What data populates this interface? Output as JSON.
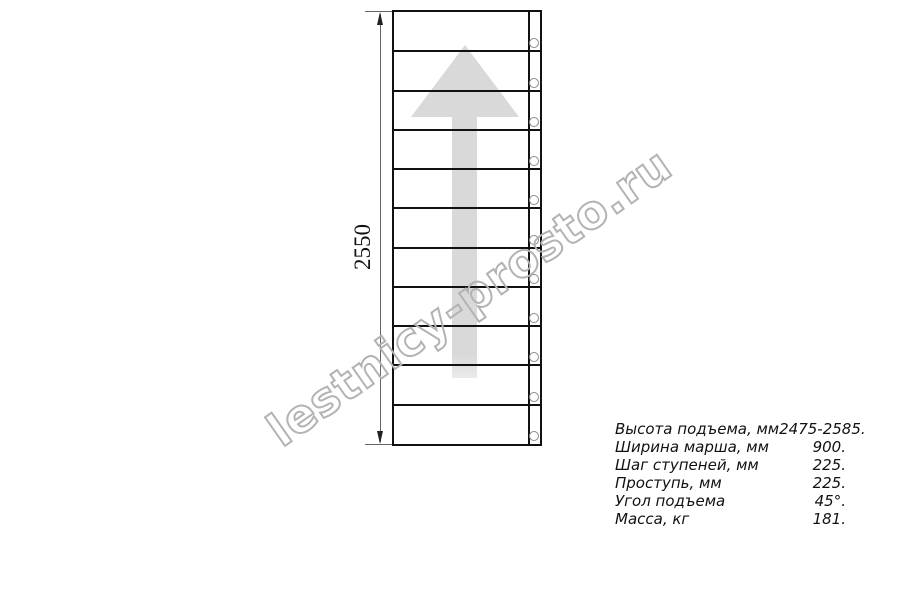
{
  "diagram": {
    "type": "staircase-plan-top-view",
    "dimension_label": "2550",
    "steps": 11,
    "watermark": "lestnicy-prosto.ru"
  },
  "specs": {
    "rows": [
      {
        "label": "Высота подъема, мм",
        "value": "2475-2585."
      },
      {
        "label": "Ширина марша, мм",
        "value": "900."
      },
      {
        "label": "Шаг ступеней, мм",
        "value": "225."
      },
      {
        "label": "Проступь, мм",
        "value": "225."
      },
      {
        "label": "Угол подъема",
        "value": "45°."
      },
      {
        "label": "Масса, кг",
        "value": "181."
      }
    ]
  },
  "colors": {
    "line": "#111111",
    "dim_line": "#666666",
    "arrow_fill": "#d9d9d9",
    "arrow_tail": "#eaeaea",
    "watermark_stroke": "#b3b3b3",
    "circle_stroke": "#8a8a8a"
  }
}
